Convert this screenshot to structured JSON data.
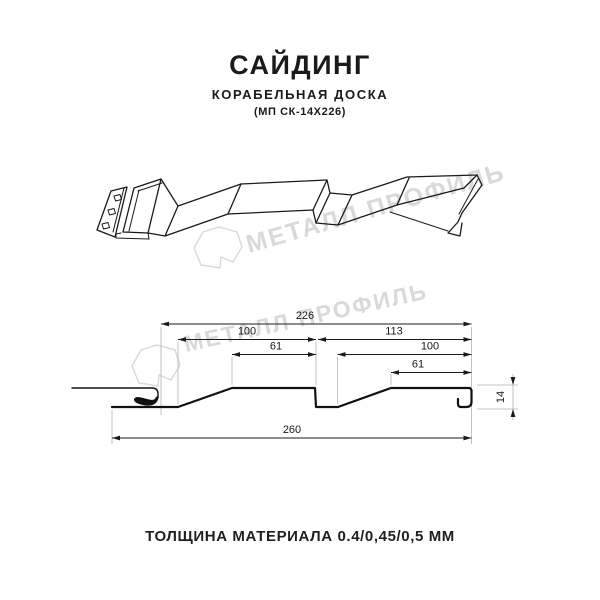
{
  "header": {
    "title": "САЙДИНГ",
    "subtitle": "КОРАБЕЛЬНАЯ ДОСКА",
    "product_code": "(МП СК-14Х226)"
  },
  "watermark": {
    "brand_text": "МЕТАЛЛ ПРОФИЛЬ",
    "color": "#d9d9d9"
  },
  "drawing": {
    "line_color": "#1a1a1a",
    "extension_line_color": "#b3b3b3"
  },
  "section_dimensions": {
    "overall_width": "226",
    "board1_width": "100",
    "board1_top_flat": "61",
    "board2_span": "113",
    "board2_width": "100",
    "board2_top_flat": "61",
    "total_width": "260",
    "profile_height": "14"
  },
  "footer": {
    "thickness_note": "ТОЛЩИНА МАТЕРИАЛА 0.4/0,45/0,5 ММ"
  }
}
